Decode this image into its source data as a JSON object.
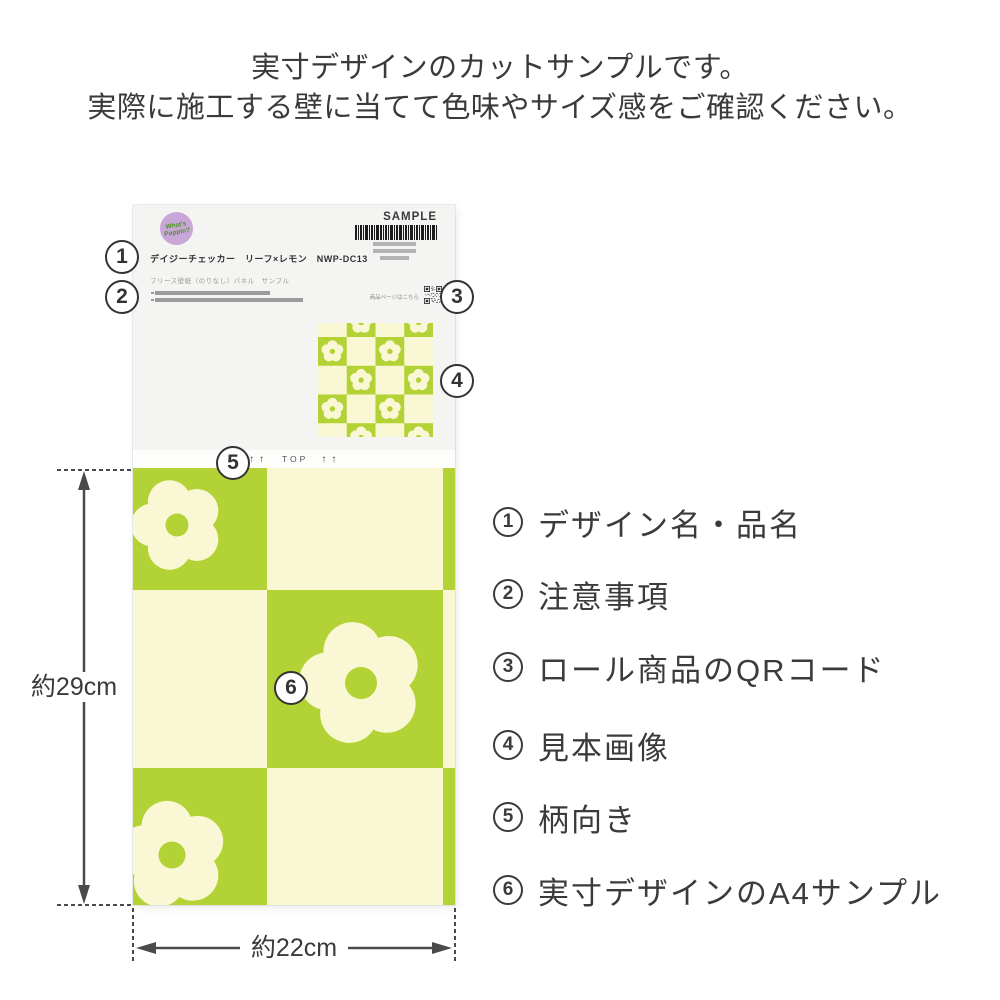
{
  "header": {
    "line1": "実寸デザインのカットサンプルです。",
    "line2": "実際に施工する壁に当てて色味やサイズ感をご確認ください。"
  },
  "paper": {
    "logo": {
      "line1": "What's",
      "line2": "Poppin?"
    },
    "sample_mark": "SAMPLE",
    "product_title": "デイジーチェッカー　リーフ×レモン　NWP-DC13",
    "product_subtitle": "フリース壁紙（のりなし）パネル　サンプル",
    "qr_caption": "商品ページはこちら",
    "orientation": {
      "left_arrows": "↑↑",
      "label": "TOP",
      "right_arrows": "↑↑"
    }
  },
  "dimensions": {
    "height": "約29cm",
    "width": "約22cm"
  },
  "callouts": [
    "1",
    "2",
    "3",
    "4",
    "5",
    "6"
  ],
  "legend": [
    {
      "num": "1",
      "label": "デザイン名・品名"
    },
    {
      "num": "2",
      "label": "注意事項"
    },
    {
      "num": "3",
      "label": "ロール商品のQRコード"
    },
    {
      "num": "4",
      "label": "見本画像"
    },
    {
      "num": "5",
      "label": "柄向き"
    },
    {
      "num": "6",
      "label": "実寸デザインのA4サンプル"
    }
  ],
  "colors": {
    "pattern_green": "#b3d235",
    "pattern_cream": "#faf8d4",
    "paper_bg": "#f4f4f2",
    "logo_purple": "#c9a6d8",
    "logo_text_green": "#4e9426",
    "text_dark": "#3a3a3a"
  }
}
